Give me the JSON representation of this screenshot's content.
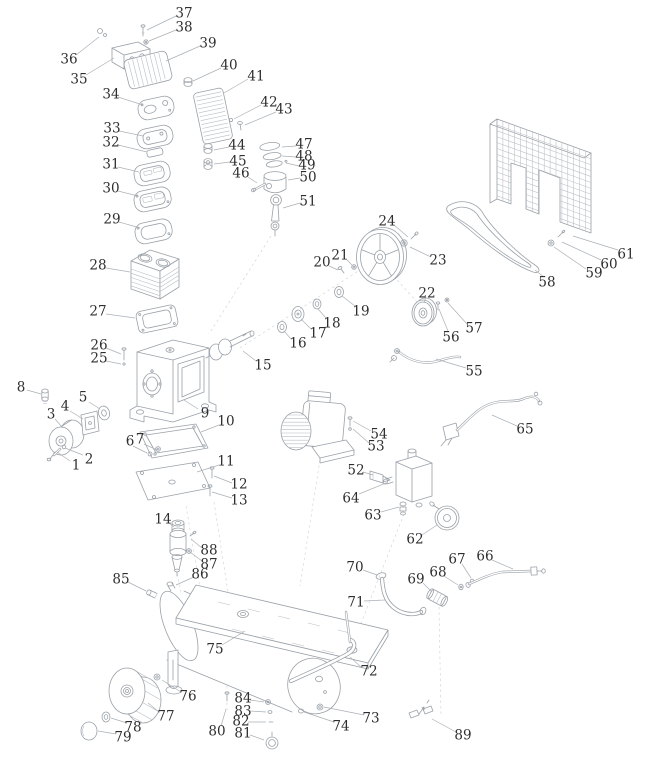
{
  "figure": {
    "width": 656,
    "height": 768,
    "background": "#ffffff",
    "drawing_line_color": "#9aa1a8",
    "light_line_color": "#b8bec5",
    "leader_color": "#aab0b6",
    "label_color": "#2e2e2e"
  },
  "diagram": {
    "type": "exploded-parts-diagram",
    "subject": "Air compressor exploded parts view",
    "part_count": 89,
    "labels": [
      {
        "n": "1",
        "x": 76,
        "y": 465,
        "leader": [
          70,
          461,
          57,
          452
        ]
      },
      {
        "n": "2",
        "x": 89,
        "y": 459,
        "leader": [
          83,
          455,
          65,
          448
        ]
      },
      {
        "n": "3",
        "x": 51,
        "y": 414,
        "leader": [
          55,
          419,
          63,
          428
        ]
      },
      {
        "n": "4",
        "x": 65,
        "y": 406,
        "leader": [
          70,
          411,
          83,
          419
        ]
      },
      {
        "n": "5",
        "x": 83,
        "y": 397,
        "leader": [
          89,
          402,
          100,
          409
        ]
      },
      {
        "n": "6",
        "x": 130,
        "y": 441,
        "leader": [
          133,
          446,
          147,
          453
        ]
      },
      {
        "n": "7",
        "x": 140,
        "y": 439,
        "leader": [
          144,
          444,
          157,
          450
        ]
      },
      {
        "n": "8",
        "x": 21,
        "y": 387,
        "leader": [
          27,
          390,
          41,
          394
        ]
      },
      {
        "n": "9",
        "x": 205,
        "y": 413,
        "leader": [
          198,
          409,
          184,
          400
        ]
      },
      {
        "n": "10",
        "x": 226,
        "y": 421,
        "leader": [
          219,
          425,
          201,
          432
        ]
      },
      {
        "n": "11",
        "x": 226,
        "y": 461,
        "leader": [
          219,
          465,
          197,
          472
        ]
      },
      {
        "n": "12",
        "x": 239,
        "y": 484,
        "leader": [
          232,
          483,
          214,
          476
        ]
      },
      {
        "n": "13",
        "x": 239,
        "y": 500,
        "leader": [
          232,
          498,
          212,
          492
        ]
      },
      {
        "n": "14",
        "x": 163,
        "y": 519,
        "leader": [
          168,
          522,
          174,
          527
        ]
      },
      {
        "n": "15",
        "x": 263,
        "y": 365,
        "leader": [
          256,
          361,
          243,
          351
        ]
      },
      {
        "n": "16",
        "x": 298,
        "y": 343,
        "leader": [
          291,
          339,
          284,
          331
        ]
      },
      {
        "n": "17",
        "x": 318,
        "y": 333,
        "leader": [
          311,
          329,
          301,
          319
        ]
      },
      {
        "n": "18",
        "x": 332,
        "y": 323,
        "leader": [
          326,
          318,
          318,
          309
        ]
      },
      {
        "n": "19",
        "x": 361,
        "y": 311,
        "leader": [
          355,
          306,
          342,
          296
        ]
      },
      {
        "n": "20",
        "x": 322,
        "y": 262,
        "leader": [
          329,
          266,
          338,
          270
        ]
      },
      {
        "n": "21",
        "x": 340,
        "y": 255,
        "leader": [
          346,
          259,
          352,
          265
        ]
      },
      {
        "n": "22",
        "x": 427,
        "y": 293,
        "leader": [
          426,
          297,
          424,
          303
        ]
      },
      {
        "n": "23",
        "x": 438,
        "y": 260,
        "leader": [
          431,
          257,
          410,
          247
        ]
      },
      {
        "n": "24",
        "x": 387,
        "y": 221,
        "leader": [
          394,
          225,
          408,
          237
        ]
      },
      {
        "n": "25",
        "x": 99,
        "y": 358,
        "leader": [
          106,
          361,
          121,
          364
        ]
      },
      {
        "n": "26",
        "x": 99,
        "y": 345,
        "leader": [
          106,
          348,
          121,
          354
        ]
      },
      {
        "n": "27",
        "x": 98,
        "y": 311,
        "leader": [
          106,
          314,
          135,
          318
        ]
      },
      {
        "n": "28",
        "x": 98,
        "y": 265,
        "leader": [
          106,
          268,
          130,
          272
        ]
      },
      {
        "n": "29",
        "x": 112,
        "y": 219,
        "leader": [
          119,
          222,
          140,
          228
        ]
      },
      {
        "n": "30",
        "x": 111,
        "y": 188,
        "leader": [
          118,
          191,
          138,
          196
        ]
      },
      {
        "n": "31",
        "x": 111,
        "y": 164,
        "leader": [
          118,
          167,
          139,
          172
        ]
      },
      {
        "n": "32",
        "x": 111,
        "y": 142,
        "leader": [
          118,
          145,
          147,
          152
        ]
      },
      {
        "n": "33",
        "x": 112,
        "y": 128,
        "leader": [
          119,
          131,
          143,
          136
        ]
      },
      {
        "n": "34",
        "x": 111,
        "y": 94,
        "leader": [
          118,
          97,
          143,
          105
        ]
      },
      {
        "n": "35",
        "x": 79,
        "y": 79,
        "leader": [
          86,
          75,
          114,
          58
        ]
      },
      {
        "n": "36",
        "x": 69,
        "y": 59,
        "leader": [
          76,
          55,
          99,
          37
        ]
      },
      {
        "n": "37",
        "x": 184,
        "y": 13,
        "leader": [
          176,
          16,
          147,
          30
        ]
      },
      {
        "n": "38",
        "x": 184,
        "y": 27,
        "leader": [
          176,
          30,
          149,
          41
        ]
      },
      {
        "n": "39",
        "x": 208,
        "y": 43,
        "leader": [
          200,
          46,
          166,
          61
        ]
      },
      {
        "n": "40",
        "x": 229,
        "y": 65,
        "leader": [
          221,
          68,
          193,
          81
        ]
      },
      {
        "n": "41",
        "x": 256,
        "y": 76,
        "leader": [
          248,
          79,
          224,
          93
        ]
      },
      {
        "n": "42",
        "x": 269,
        "y": 102,
        "leader": [
          261,
          105,
          234,
          119
        ]
      },
      {
        "n": "43",
        "x": 284,
        "y": 109,
        "leader": [
          276,
          112,
          245,
          125
        ]
      },
      {
        "n": "44",
        "x": 237,
        "y": 145,
        "leader": [
          229,
          147,
          214,
          150
        ]
      },
      {
        "n": "45",
        "x": 238,
        "y": 161,
        "leader": [
          230,
          162,
          214,
          164
        ]
      },
      {
        "n": "46",
        "x": 241,
        "y": 173,
        "leader": [
          248,
          177,
          257,
          183
        ]
      },
      {
        "n": "47",
        "x": 304,
        "y": 144,
        "leader": [
          296,
          146,
          282,
          147
        ]
      },
      {
        "n": "48",
        "x": 304,
        "y": 156,
        "leader": [
          296,
          157,
          282,
          156
        ]
      },
      {
        "n": "49",
        "x": 307,
        "y": 165,
        "leader": [
          299,
          166,
          286,
          163
        ]
      },
      {
        "n": "50",
        "x": 308,
        "y": 177,
        "leader": [
          300,
          178,
          288,
          180
        ]
      },
      {
        "n": "51",
        "x": 308,
        "y": 201,
        "leader": [
          300,
          203,
          283,
          208
        ]
      },
      {
        "n": "52",
        "x": 356,
        "y": 470,
        "leader": [
          363,
          472,
          373,
          475
        ]
      },
      {
        "n": "53",
        "x": 376,
        "y": 446,
        "leader": [
          369,
          443,
          353,
          429
        ]
      },
      {
        "n": "54",
        "x": 379,
        "y": 434,
        "leader": [
          371,
          431,
          353,
          421
        ]
      },
      {
        "n": "55",
        "x": 474,
        "y": 371,
        "leader": [
          466,
          368,
          436,
          359
        ]
      },
      {
        "n": "56",
        "x": 451,
        "y": 337,
        "leader": [
          448,
          331,
          439,
          309
        ]
      },
      {
        "n": "57",
        "x": 474,
        "y": 328,
        "leader": [
          467,
          324,
          448,
          303
        ]
      },
      {
        "n": "58",
        "x": 547,
        "y": 282,
        "leader": [
          544,
          277,
          535,
          270
        ]
      },
      {
        "n": "59",
        "x": 594,
        "y": 273,
        "leader": [
          586,
          269,
          554,
          247
        ]
      },
      {
        "n": "60",
        "x": 609,
        "y": 264,
        "leader": [
          601,
          260,
          562,
          242
        ]
      },
      {
        "n": "61",
        "x": 626,
        "y": 254,
        "leader": [
          618,
          250,
          573,
          236
        ]
      },
      {
        "n": "62",
        "x": 415,
        "y": 539,
        "leader": [
          422,
          535,
          437,
          525
        ]
      },
      {
        "n": "63",
        "x": 373,
        "y": 515,
        "leader": [
          381,
          512,
          399,
          507
        ]
      },
      {
        "n": "64",
        "x": 351,
        "y": 498,
        "leader": [
          359,
          494,
          386,
          483
        ]
      },
      {
        "n": "65",
        "x": 525,
        "y": 429,
        "leader": [
          517,
          426,
          492,
          415
        ]
      },
      {
        "n": "66",
        "x": 485,
        "y": 556,
        "leader": [
          492,
          560,
          513,
          569
        ]
      },
      {
        "n": "67",
        "x": 457,
        "y": 559,
        "leader": [
          462,
          564,
          471,
          578
        ]
      },
      {
        "n": "68",
        "x": 438,
        "y": 572,
        "leader": [
          444,
          576,
          458,
          585
        ]
      },
      {
        "n": "69",
        "x": 416,
        "y": 579,
        "leader": [
          423,
          583,
          432,
          592
        ]
      },
      {
        "n": "70",
        "x": 355,
        "y": 567,
        "leader": [
          363,
          570,
          377,
          575
        ]
      },
      {
        "n": "71",
        "x": 356,
        "y": 602,
        "leader": [
          364,
          601,
          385,
          600
        ]
      },
      {
        "n": "72",
        "x": 369,
        "y": 671,
        "leader": [
          361,
          667,
          350,
          657
        ]
      },
      {
        "n": "73",
        "x": 371,
        "y": 718,
        "leader": [
          364,
          715,
          324,
          707
        ]
      },
      {
        "n": "74",
        "x": 341,
        "y": 726,
        "leader": [
          334,
          722,
          304,
          712
        ]
      },
      {
        "n": "75",
        "x": 215,
        "y": 649,
        "leader": [
          222,
          645,
          245,
          631
        ]
      },
      {
        "n": "76",
        "x": 188,
        "y": 696,
        "leader": [
          181,
          692,
          162,
          680
        ]
      },
      {
        "n": "77",
        "x": 166,
        "y": 716,
        "leader": [
          159,
          712,
          148,
          703
        ]
      },
      {
        "n": "78",
        "x": 133,
        "y": 727,
        "leader": [
          127,
          723,
          111,
          718
        ]
      },
      {
        "n": "79",
        "x": 123,
        "y": 737,
        "leader": [
          116,
          734,
          98,
          731
        ]
      },
      {
        "n": "80",
        "x": 217,
        "y": 731,
        "leader": [
          221,
          726,
          226,
          709
        ]
      },
      {
        "n": "81",
        "x": 243,
        "y": 733,
        "leader": [
          250,
          735,
          264,
          740
        ]
      },
      {
        "n": "82",
        "x": 241,
        "y": 721,
        "leader": [
          248,
          722,
          266,
          722
        ]
      },
      {
        "n": "83",
        "x": 243,
        "y": 711,
        "leader": [
          250,
          711,
          266,
          712
        ]
      },
      {
        "n": "84",
        "x": 243,
        "y": 698,
        "leader": [
          250,
          700,
          264,
          702
        ]
      },
      {
        "n": "85",
        "x": 121,
        "y": 579,
        "leader": [
          128,
          582,
          146,
          591
        ]
      },
      {
        "n": "86",
        "x": 200,
        "y": 574,
        "leader": [
          194,
          577,
          176,
          585
        ]
      },
      {
        "n": "87",
        "x": 209,
        "y": 564,
        "leader": [
          202,
          561,
          190,
          552
        ]
      },
      {
        "n": "88",
        "x": 209,
        "y": 550,
        "leader": [
          202,
          548,
          191,
          539
        ]
      },
      {
        "n": "89",
        "x": 463,
        "y": 735,
        "leader": [
          456,
          732,
          432,
          719
        ]
      }
    ]
  }
}
